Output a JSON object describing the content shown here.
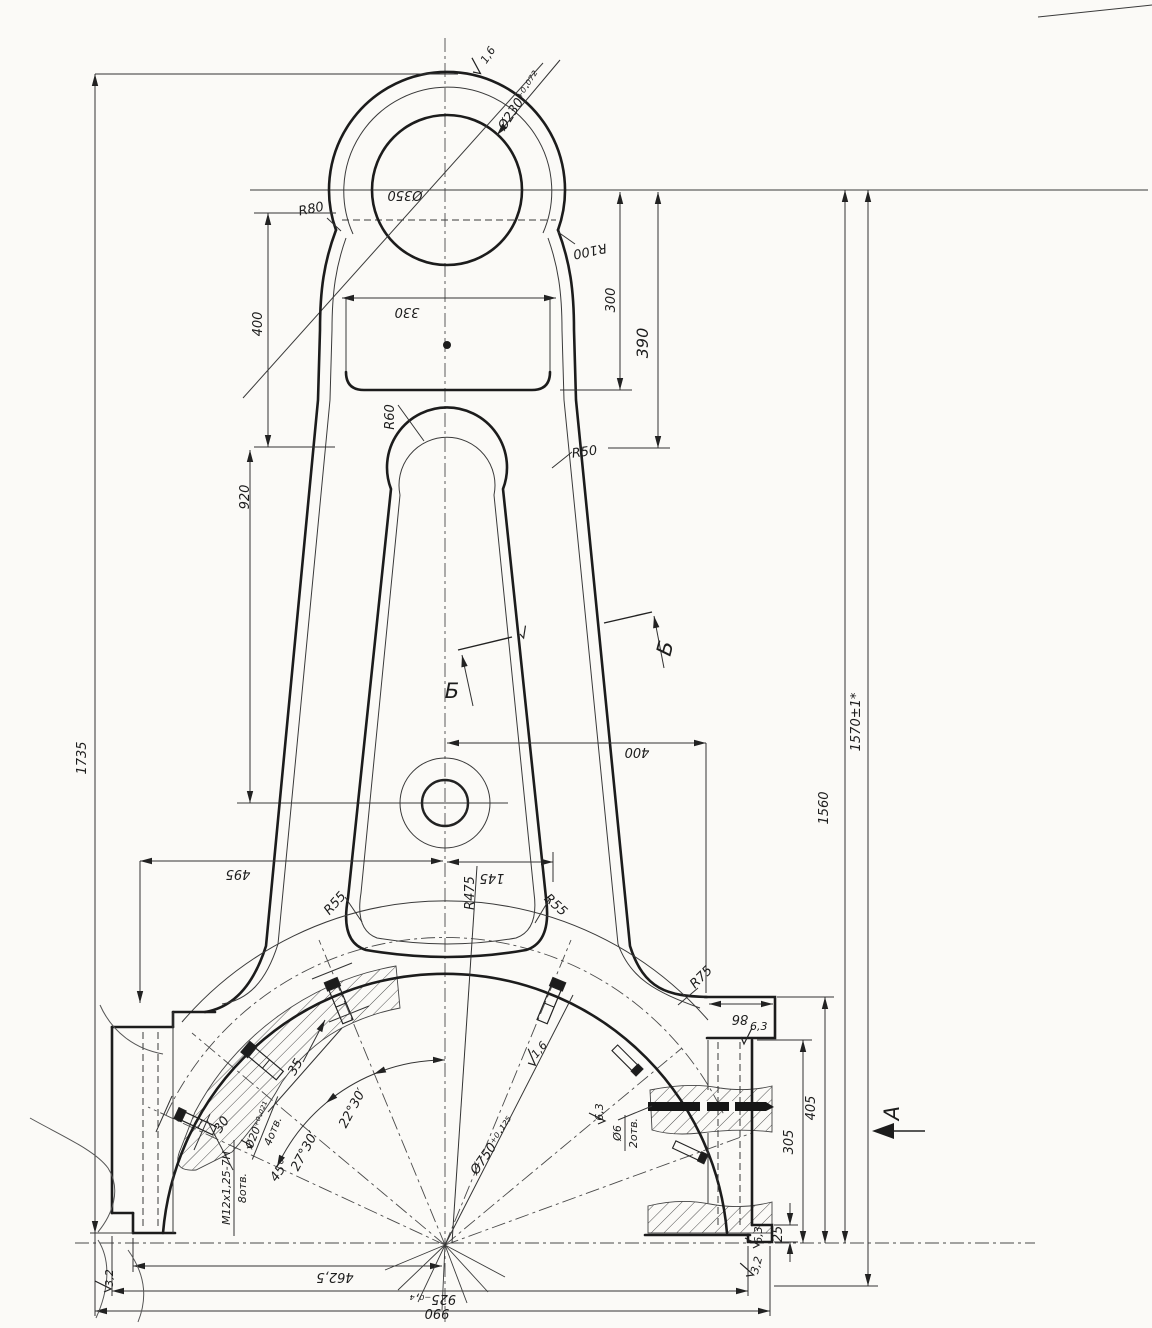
{
  "drawing": {
    "title": "Lever / connecting-rod machining drawing",
    "labels": {
      "dia230": "Ø230⁺⁰·⁰⁷²",
      "rough16_top": "1,6",
      "dia350": "Ø350",
      "r80": "R80",
      "r100": "R100",
      "d330": "330",
      "d300": "300",
      "d390": "390",
      "d400_left": "400",
      "r60": "R60",
      "r50": "R50",
      "d920": "920",
      "d1735": "1735",
      "section_b_left": "Б",
      "section_b_right": "Б",
      "d400_right": "400",
      "d1560": "1560",
      "d1570": "1570±1*",
      "d495": "495",
      "d145": "145",
      "r55_left": "R55",
      "r475": "R475",
      "r55_right": "R55",
      "r75": "R75",
      "d86": "86",
      "rough63_flange": "6,3",
      "d35": "35",
      "d30": "30",
      "rough16_mid": "1,6",
      "dia750": "Ø750⁺⁰·¹²⁵",
      "ang2230": "22°30′",
      "ang2730": "27°30′",
      "ang45": "45°",
      "dia20": "Ø20⁺⁰·⁰²¹",
      "holes4": "4отв.",
      "m12": "M12x1,25-7H",
      "holes8": "8отв.",
      "dia6": "Ø6",
      "holes2": "2отв.",
      "rough63_pin": "6,3",
      "d405": "405",
      "d305": "305",
      "view_a": "А",
      "d25": "25",
      "rough63_step": "6,3",
      "rough32_right": "3,2",
      "rough32_left": "3,2",
      "d462": "462,5",
      "d925": "925₋₀,₄",
      "d990": "990"
    }
  }
}
